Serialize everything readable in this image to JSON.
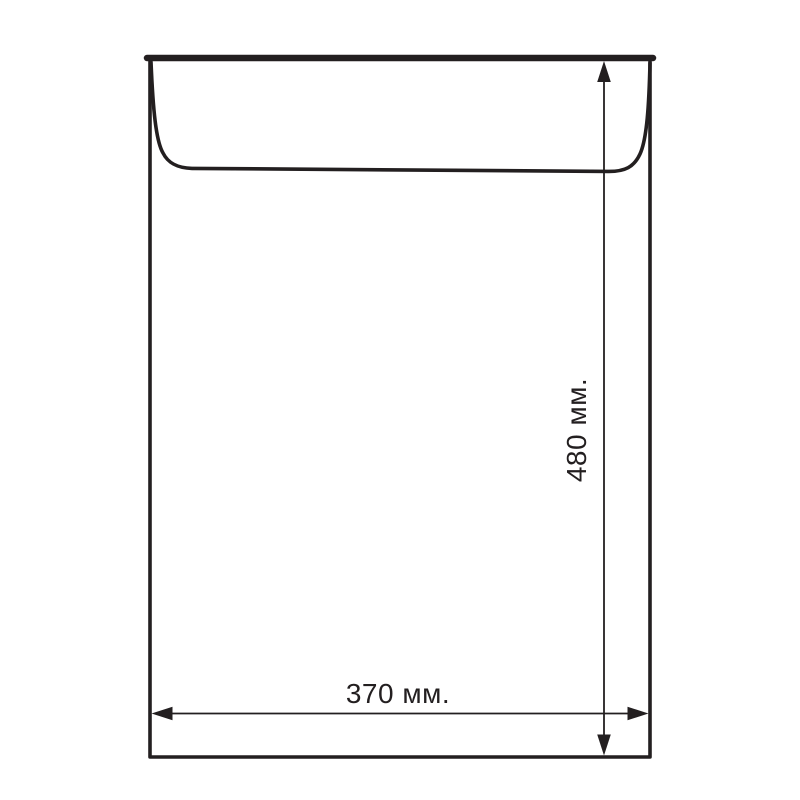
{
  "diagram": {
    "type": "envelope-dimension-drawing",
    "width_label": "370 мм.",
    "height_label": "480 мм.",
    "width_mm": 370,
    "height_mm": 480,
    "line_color": "#231f20",
    "background_color": "#ffffff"
  }
}
